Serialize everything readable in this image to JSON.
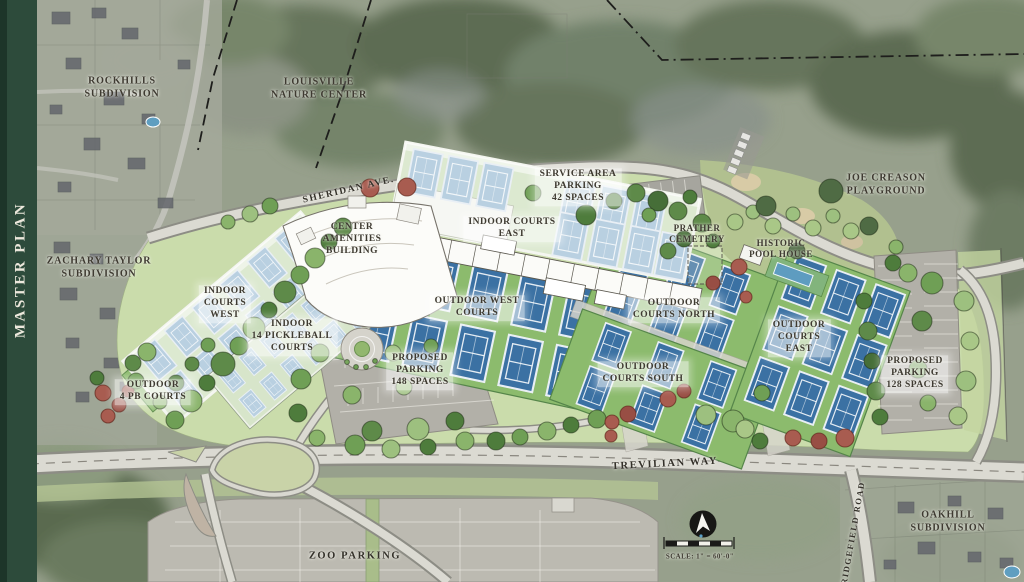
{
  "sidebar": {
    "title": "MASTER PLAN"
  },
  "map": {
    "labels": {
      "rockhills": "ROCKHILLS\nSUBDIVISION",
      "nature_center": "LOUISVILLE\nNATURE CENTER",
      "joe_creason": "JOE CREASON\nPLAYGROUND",
      "sheridan_ave": "SHERIDAN AVE.",
      "service_parking": "SERVICE AREA\nPARKING\n42 SPACES",
      "center_amenities": "CENTER\nAMENITIES\nBUILDING",
      "indoor_courts_east": "INDOOR COURTS\nEAST",
      "prather_cemetery": "PRATHER\nCEMETERY",
      "historic_pool_house": "HISTORIC\nPOOL HOUSE",
      "zachary_taylor": "ZACHARY TAYLOR\nSUBDIVISION",
      "indoor_courts_west": "INDOOR\nCOURTS\nWEST",
      "indoor_pickleball": "INDOOR\n14 PICKLEBALL\nCOURTS",
      "outdoor_west": "OUTDOOR WEST\nCOURTS",
      "outdoor_north": "OUTDOOR\nCOURTS NORTH",
      "outdoor_east": "OUTDOOR\nCOURTS\nEAST",
      "outdoor_south": "OUTDOOR\nCOURTS SOUTH",
      "outdoor_pb": "OUTDOOR\n4 PB COURTS",
      "parking_148": "PROPOSED\nPARKING\n148 SPACES",
      "parking_128": "PROPOSED\nPARKING\n128 SPACES",
      "trevilian_way": "TREVILIAN WAY",
      "ridgefield_road": "RIDGEFIELD ROAD",
      "oakhill": "OAKHILL\nSUBDIVISION",
      "zoo_parking": "ZOO PARKING",
      "scale": "SCALE: 1\" = 60'-0\""
    },
    "colors": {
      "sidebar_green": "#2d4b3b",
      "court_blue": "#3b71a3",
      "court_surface_green": "#8cbb6d",
      "indoor_building_pale": "#dce9d0",
      "road_gray": "#d9d8d0",
      "red_tree": "#a85c50"
    }
  }
}
